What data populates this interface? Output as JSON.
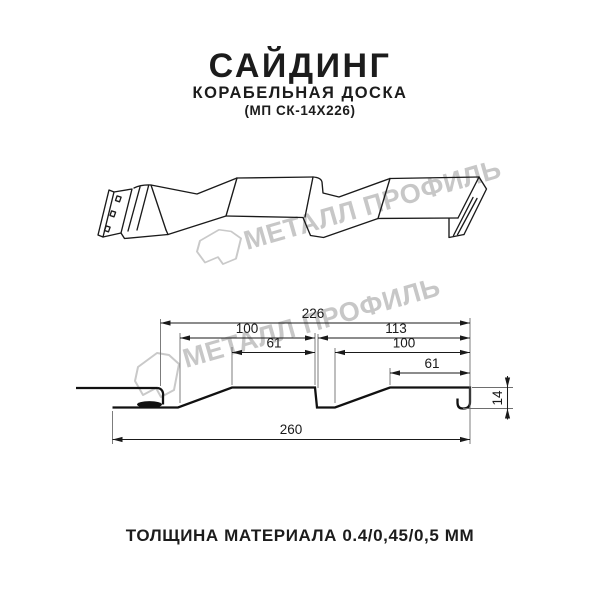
{
  "header": {
    "title": "САЙДИНГ",
    "subtitle": "КОРАБЕЛЬНАЯ ДОСКА",
    "model_code": "(МП СК-14Х226)"
  },
  "watermark": {
    "text": "МЕТАЛЛ ПРОФИЛЬ",
    "logo": "metall-profil-logo",
    "color": "#c7c7c7"
  },
  "diagram": {
    "type": "siding-profile-technical-drawing",
    "views": [
      "3d-perspective-view",
      "cross-section-with-dimensions"
    ],
    "dimensions_mm": {
      "module_width": "226",
      "board1_width": "100",
      "board1_face": "61",
      "board2_module": "113",
      "board2_width": "100",
      "board2_face": "61",
      "overall_width": "260",
      "profile_height": "14"
    }
  },
  "footer": {
    "thickness_note": "ТОЛЩИНА МАТЕРИАЛА 0.4/0,45/0,5 ММ"
  }
}
